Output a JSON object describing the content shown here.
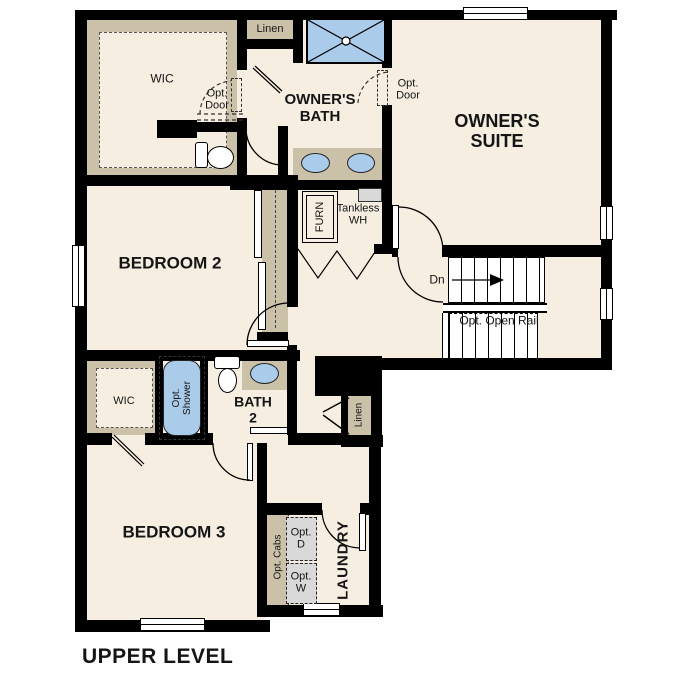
{
  "title": "UPPER LEVEL",
  "colors": {
    "floor": "#f5eee1",
    "closet": "#cbc1a9",
    "blue": "#aacbe9",
    "gray": "#d9d9d9",
    "wall": "#000000"
  },
  "rooms": {
    "owners_suite": {
      "line1": "OWNER'S",
      "line2": "SUITE"
    },
    "owners_bath": {
      "line1": "OWNER'S",
      "line2": "BATH"
    },
    "bedroom2": "BEDROOM 2",
    "bedroom3": "BEDROOM 3",
    "bath2": {
      "line1": "BATH",
      "line2": "2"
    },
    "laundry": "LAUNDRY"
  },
  "labels": {
    "wic_owners": "WIC",
    "wic_bed3": "WIC",
    "linen_top": "Linen",
    "linen_hall": "Linen",
    "opt_door_bath": {
      "line1": "Opt.",
      "line2": "Door"
    },
    "opt_door_suite": {
      "line1": "Opt.",
      "line2": "Door"
    },
    "furnace": "FURN",
    "tankless": {
      "line1": "Tankless",
      "line2": "WH"
    },
    "stairs_down": "Dn",
    "opt_open_rail": "Opt. Open Rail",
    "opt_shower": {
      "line1": "Opt.",
      "line2": "Shower"
    },
    "opt_cabs": "Opt. Cabs",
    "opt_dryer": {
      "line1": "Opt.",
      "line2": "D"
    },
    "opt_washer": {
      "line1": "Opt.",
      "line2": "W"
    }
  }
}
